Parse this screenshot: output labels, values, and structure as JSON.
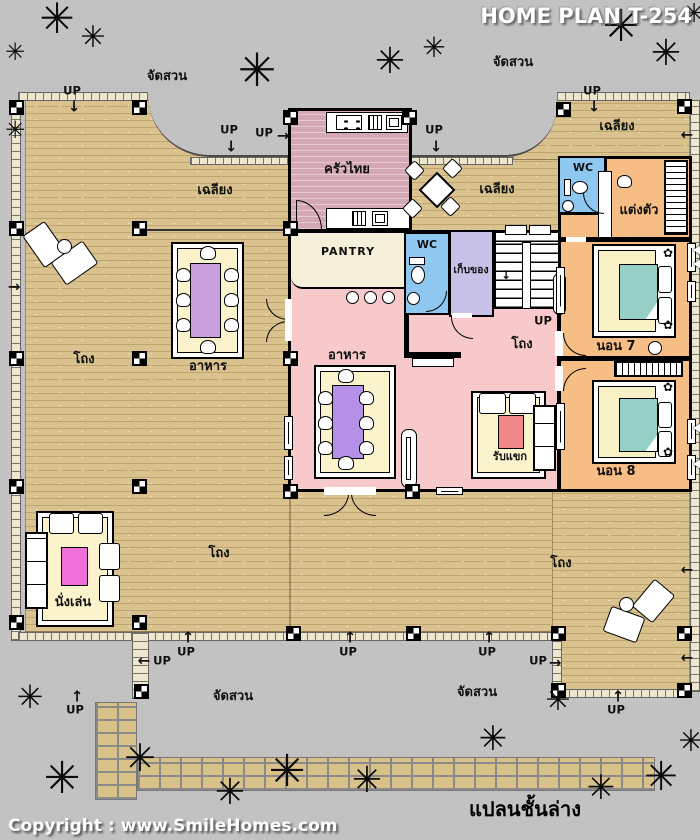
{
  "header": {
    "title": "HOME PLAN T-254"
  },
  "footer": {
    "copyright": "Copyright : www.SmileHomes.com",
    "caption": "แปลนชั้นล่าง"
  },
  "labels": {
    "garden": "จัดสวน",
    "porch": "เฉลียง",
    "hall": "โถง",
    "up": "UP",
    "kitchen": "ครัวไทย",
    "pantry": "PANTRY",
    "wc": "WC",
    "storage": "เก็บของ",
    "dressing": "แต่งตัว",
    "bedroom7": "นอน 7",
    "bedroom8": "นอน 8",
    "dining": "อาหาร",
    "guest": "รับแขก",
    "sitting": "นั่งเล่น"
  },
  "icons": {
    "tree": "✳",
    "flower": "✿",
    "arrow_up": "↑",
    "arrow_down": "↓",
    "arrow_left": "←",
    "arrow_right": "→"
  },
  "colors": {
    "background": "#c2c2c2",
    "deck": "#d9c28e",
    "kitchen_floor": "#d5a9b3",
    "living_floor": "#f8c9ca",
    "pantry": "#f6efd9",
    "wc": "#8ec8f0",
    "storage": "#c9c2e8",
    "bedroom": "#f6bd85",
    "mat": "#faf3cc",
    "table_purple": "#b491e6",
    "blanket_teal": "#96cfc6"
  }
}
